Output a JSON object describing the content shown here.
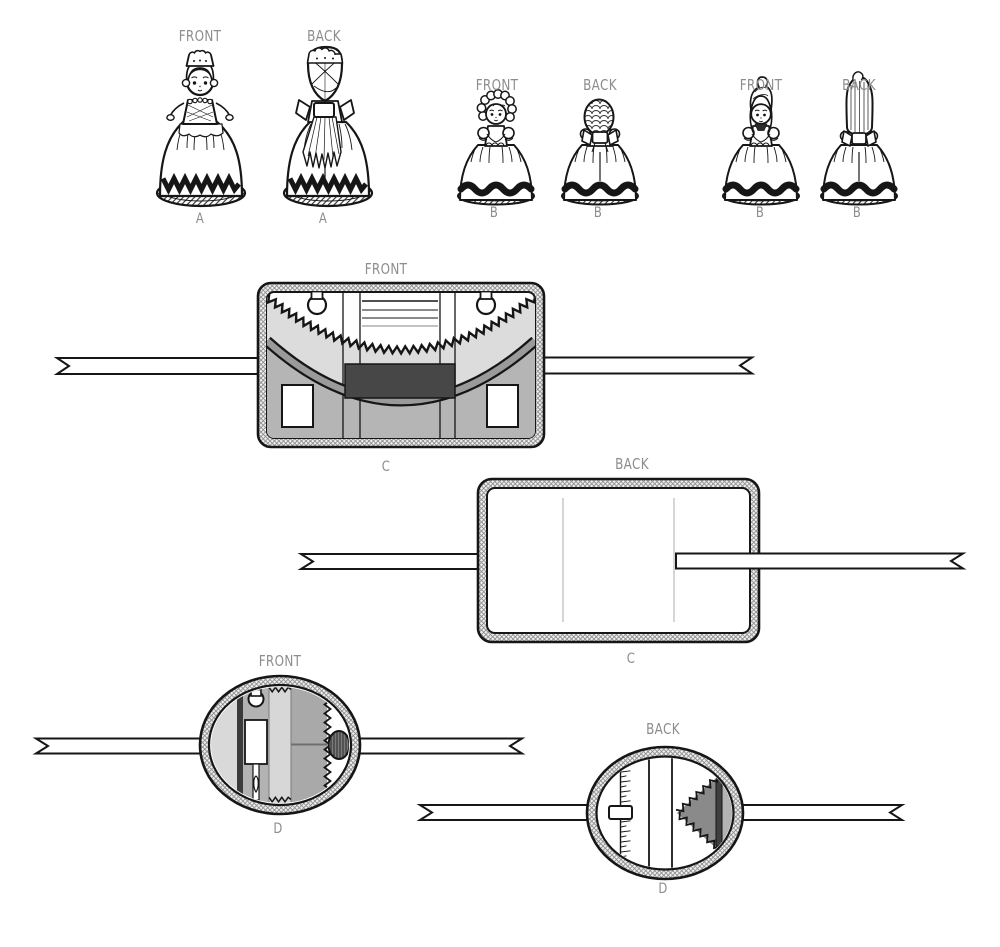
{
  "figures": {
    "doll_a": {
      "front_view_label": "FRONT",
      "back_view_label": "BACK",
      "front_letter": "A",
      "back_letter": "A"
    },
    "doll_b_curly": {
      "front_view_label": "FRONT",
      "back_view_label": "BACK",
      "front_letter": "B",
      "back_letter": "B"
    },
    "doll_b_longhair": {
      "front_view_label": "FRONT",
      "back_view_label": "BACK",
      "front_letter": "B",
      "back_letter": "B"
    },
    "organizer_c": {
      "front_view_label": "FRONT",
      "front_letter": "C",
      "back_view_label": "BACK",
      "back_letter": "C"
    },
    "organizer_d": {
      "front_view_label": "FRONT",
      "front_letter": "D",
      "back_view_label": "BACK",
      "back_letter": "D"
    }
  },
  "palette": {
    "label_gray": "#8d8d8d",
    "line_black": "#161616",
    "light_gray": "#dcdcdc",
    "mid_gray": "#b5b5b5",
    "shadow_gray": "#9a9a9a",
    "dark_gray": "#474747"
  }
}
